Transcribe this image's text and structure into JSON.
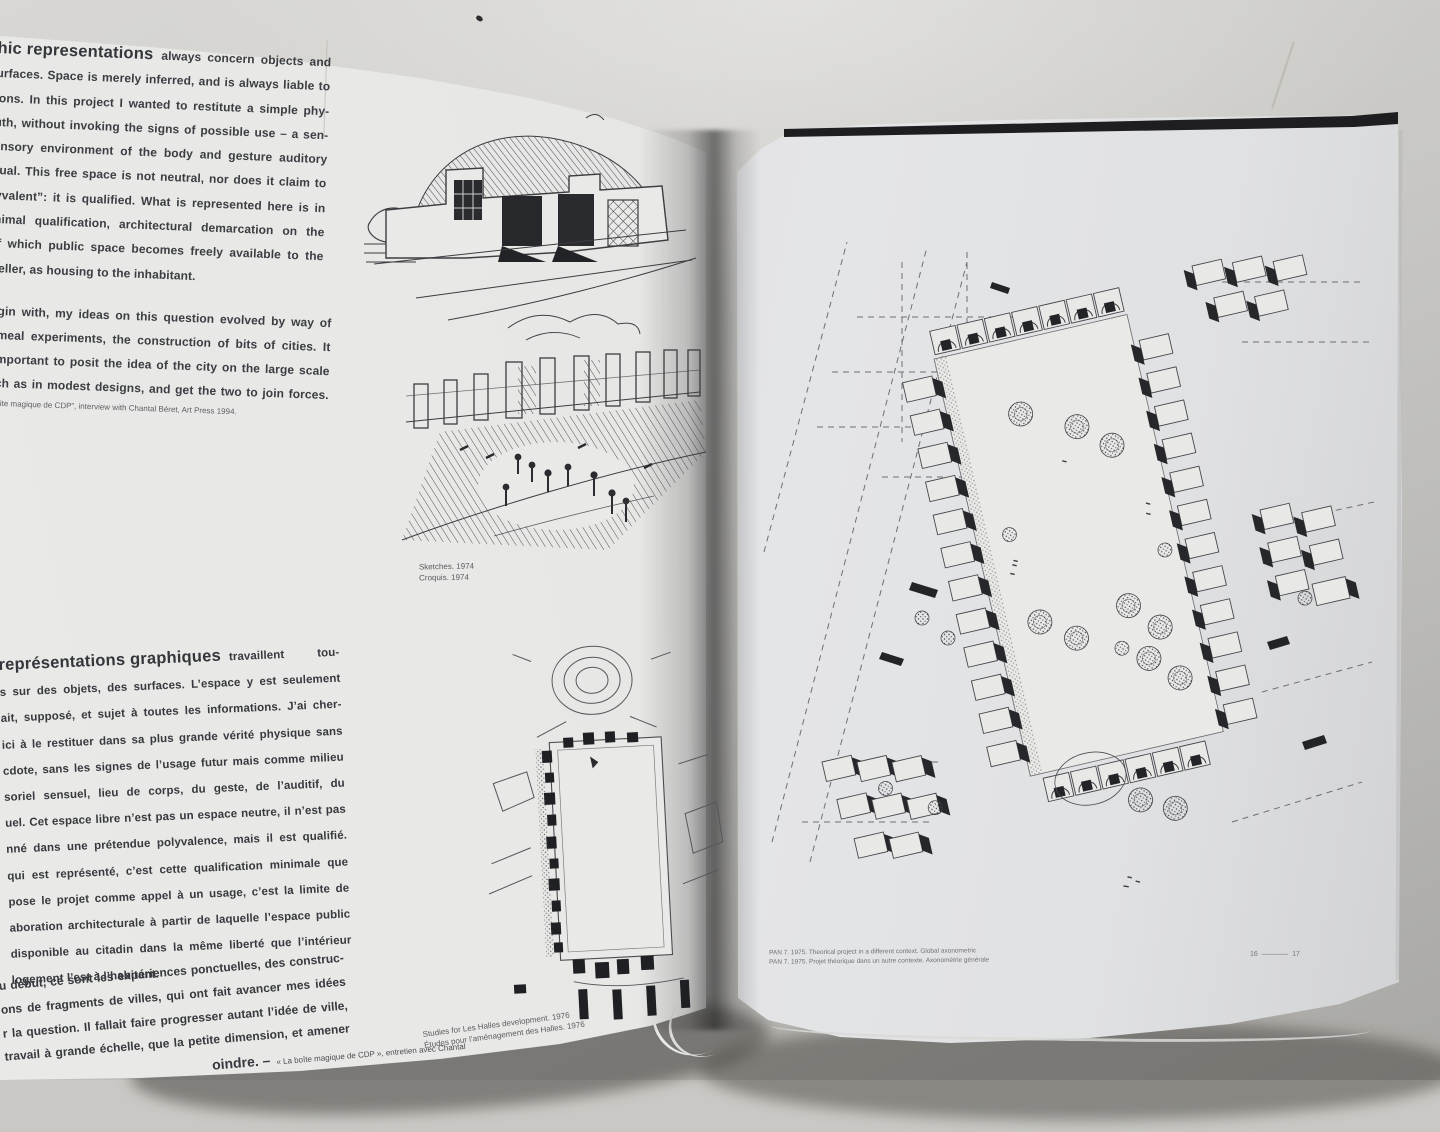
{
  "colors": {
    "surface": "#c9c8c4",
    "page_left": "#e7e7e5",
    "page_right": "#e2e3e5",
    "ink": "#3a3d41",
    "caption": "#595c5f",
    "cover_edge": "#1e1e20"
  },
  "left_page": {
    "intro_en": {
      "lead": "hic representations",
      "lead_rest": "always concern objects and",
      "lines": [
        "urfaces. Space is merely inferred, and is always liable to",
        "ions. In this project I wanted to restitute a simple phy-",
        "uth, without invoking the signs of possible use – a sen-",
        "ensory environment of the body and gesture auditory",
        "sual. This free space is not neutral, nor does it claim to",
        "lyvalent”: it is qualified. What is represented here is in",
        "inimal qualification, architectural demarcation on the",
        "of which public space becomes freely available to the"
      ],
      "last_line": "weller, as housing to the inhabitant."
    },
    "para2_en": {
      "lines": [
        "gin with, my ideas on this question evolved by way of",
        "meal experiments, the construction of bits of cities. It",
        "mportant to posit the idea of the city on the large scale",
        "ch as in modest designs, and get the two to join forces."
      ]
    },
    "footnote_en": "ite magique de CDP”, interview with Chantal Béret, Art Press 1994.",
    "sketches_caption": {
      "en": "Sketches. 1974",
      "fr": "Croquis. 1974"
    },
    "intro_fr": {
      "lead": "représentations graphiques",
      "lead_rest": "travaillent tou-",
      "lines": [
        "s sur des objets, des surfaces. L’espace y est seulement",
        "ait, supposé, et sujet à toutes les informations. J’ai cher-",
        "ici à le restituer dans sa plus grande vérité physique sans",
        "cdote, sans les signes de l’usage futur mais comme milieu",
        "soriel sensuel, lieu de corps, du geste, de l’auditif, du",
        "uel. Cet espace libre n’est pas un espace neutre, il n’est pas",
        "nné dans une prétendue polyvalence, mais il est qualifié.",
        "qui est représenté, c’est cette qualification minimale que",
        "pose le projet comme appel à un usage, c’est la limite de",
        "aboration architecturale à partir de laquelle l’espace public",
        "disponible au citadin dans la même liberté que l’intérieur"
      ],
      "last_line": "logement l’est à l’habitant."
    },
    "para2_fr": {
      "lines": [
        "u début, ce sont les expériences ponctuelles, des construc-",
        "ons de fragments de villes, qui ont fait avancer mes idées",
        "r la question. Il fallait faire progresser autant l’idée de ville,",
        "travail à grande échelle, que la petite dimension, et amener"
      ],
      "last_line_lead": "oindre. –",
      "last_line_note": "« La boîte magique de CDP », entretien avec Chantal"
    },
    "halles_caption": {
      "en": "Studies for Les Halles development. 1976",
      "fr": "Études pour l’aménagement des Halles. 1976"
    }
  },
  "right_page": {
    "pan_caption": {
      "en": "PAN 7. 1975. Theorical project in a different context. Global axonometric",
      "fr": "PAN 7. 1975. Projet théorique dans un autre contexte. Axonométrie générale"
    },
    "page_numbers": {
      "left": "16",
      "right": "17"
    }
  },
  "drawings": {
    "building_sketch": "pen sketch of low pavilion with trees",
    "plaza_sketch": "pen sketch of colonnade square with figures",
    "halles_plan": "plan study with rotunda and long courtyard",
    "axonometric": "axonometric of housing blocks around planted courtyard"
  }
}
